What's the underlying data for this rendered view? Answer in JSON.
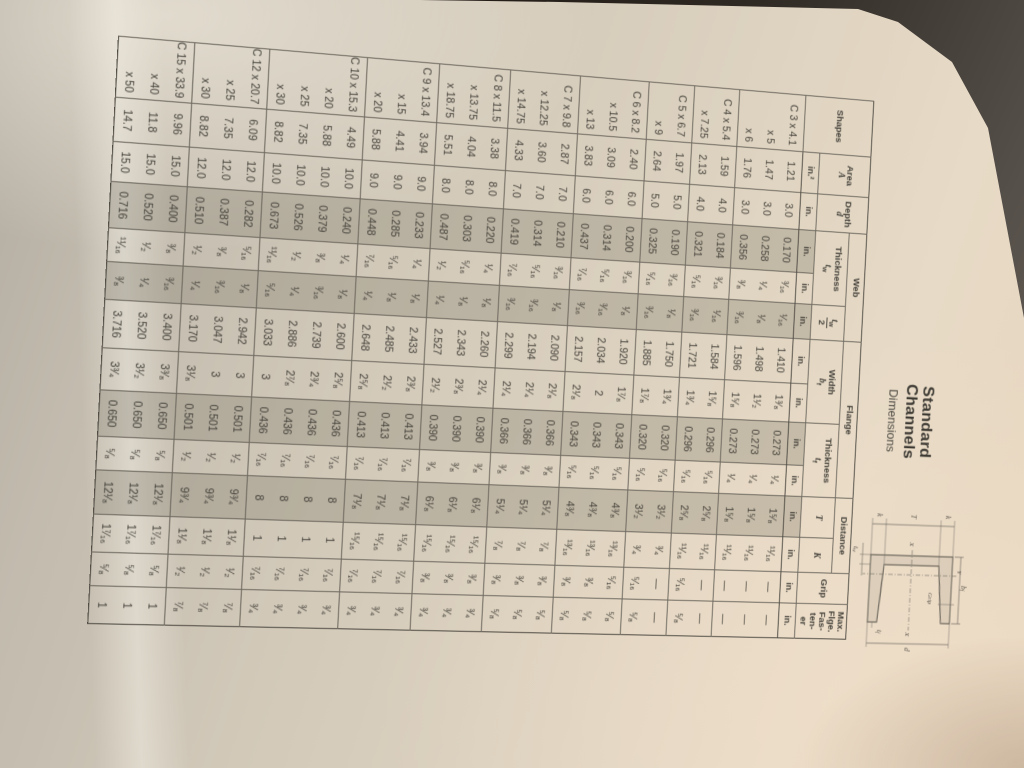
{
  "photo": {
    "background_dark": "#211a15",
    "background_wedge": "#6b645b",
    "paper_light": "#e7dac6",
    "paper_shadow": "#b2aba0",
    "table_line": "#6e695f",
    "band_shade": "#b4aea2",
    "ink": "#44413a"
  },
  "title": {
    "line1": "Standard",
    "line2": "Channels",
    "line3": "Dimensions"
  },
  "diagram": {
    "k_top": "k",
    "t_mid": "T",
    "k_bottom": "k",
    "depth": "d",
    "axis_x_left": "X",
    "axis_x_right": "X",
    "axis_y": "Y",
    "grip": "Grip",
    "width_sym": "b",
    "width_sub": "f",
    "web_sym": "t",
    "web_sub": "w",
    "flange_sym": "t",
    "flange_sub": "f"
  },
  "table": {
    "headers": {
      "shapes": "Shapes",
      "area": "Area",
      "area_sym": "A",
      "depth": "Depth",
      "depth_sym": "d",
      "web": "Web",
      "thickness": "Thickness",
      "t_sym": "t",
      "w_sub": "w",
      "den2": "2",
      "flange": "Flange",
      "width": "Width",
      "b_sym": "b",
      "f_sub": "f",
      "distance": "Distance",
      "T": "T",
      "K": "K",
      "grip": "Grip",
      "max_lines": [
        "Max.",
        "Flge.",
        "Fas-",
        "ten-",
        "er"
      ]
    },
    "units": [
      "in.²",
      "in.",
      "in.",
      "in.",
      "in.",
      "in.",
      "in.",
      "in.",
      "in.",
      "in.",
      "in.",
      "in.",
      "in."
    ],
    "columns": [
      "Shapes",
      "Area A",
      "Depth d",
      "Web Thickness tw (dec)",
      "Web Thickness tw (frac)",
      "tw/2",
      "Flange Width bf (dec)",
      "Flange Width bf (frac)",
      "Flange Thickness tf (dec)",
      "Flange Thickness tf (frac)",
      "Distance T",
      "Distance K",
      "Grip",
      "Max. Flge. Fastener"
    ],
    "groups": [
      {
        "rows": [
          [
            "C 3 x 4.1",
            "1.21",
            "3.0",
            "0.170",
            "³⁄₁₆",
            "¹⁄₁₆",
            "1.410",
            "1³⁄₈",
            "0.273",
            "¹⁄₄",
            "1⁵⁄₈",
            "¹¹⁄₁₆",
            "—",
            "—"
          ],
          [
            "x 5",
            "1.47",
            "3.0",
            "0.258",
            "¹⁄₄",
            "¹⁄₈",
            "1.498",
            "1¹⁄₂",
            "0.273",
            "¹⁄₄",
            "1⁵⁄₈",
            "¹¹⁄₁₆",
            "—",
            "—"
          ],
          [
            "x 6",
            "1.76",
            "3.0",
            "0.356",
            "³⁄₈",
            "³⁄₁₆",
            "1.596",
            "1⁵⁄₈",
            "0.273",
            "¹⁄₄",
            "1⁵⁄₈",
            "¹¹⁄₁₆",
            "—",
            "—"
          ]
        ]
      },
      {
        "rows": [
          [
            "C 4 x 5.4",
            "1.59",
            "4.0",
            "0.184",
            "³⁄₁₆",
            "¹⁄₁₆",
            "1.584",
            "1⁵⁄₈",
            "0.296",
            "⁵⁄₁₆",
            "2⁵⁄₈",
            "¹¹⁄₁₆",
            "—",
            "—"
          ],
          [
            "x 7.25",
            "2.13",
            "4.0",
            "0.321",
            "⁵⁄₁₆",
            "³⁄₁₆",
            "1.721",
            "1³⁄₄",
            "0.296",
            "⁵⁄₁₆",
            "2⁵⁄₈",
            "¹¹⁄₁₆",
            "⁵⁄₁₆",
            "⁵⁄₈"
          ]
        ]
      },
      {
        "rows": [
          [
            "C 5 x 6.7",
            "1.97",
            "5.0",
            "0.190",
            "³⁄₁₆",
            "¹⁄₈",
            "1.750",
            "1³⁄₄",
            "0.320",
            "⁵⁄₁₆",
            "3¹⁄₂",
            "³⁄₄",
            "—",
            "—"
          ],
          [
            "x 9",
            "2.64",
            "5.0",
            "0.325",
            "⁵⁄₁₆",
            "³⁄₁₆",
            "1.885",
            "1⁷⁄₈",
            "0.320",
            "⁵⁄₁₆",
            "3¹⁄₂",
            "³⁄₄",
            "⁵⁄₁₆",
            "⁵⁄₈"
          ]
        ]
      },
      {
        "rows": [
          [
            "C 6 x 8.2",
            "2.40",
            "6.0",
            "0.200",
            "³⁄₁₆",
            "¹⁄₈",
            "1.920",
            "1⁷⁄₈",
            "0.343",
            "⁵⁄₁₆",
            "4³⁄₈",
            "¹³⁄₁₆",
            "⁵⁄₁₆",
            "⁵⁄₈"
          ],
          [
            "x 10.5",
            "3.09",
            "6.0",
            "0.314",
            "⁵⁄₁₆",
            "³⁄₁₆",
            "2.034",
            "2",
            "0.343",
            "⁵⁄₁₆",
            "4³⁄₈",
            "¹³⁄₁₆",
            "³⁄₈",
            "⁵⁄₈"
          ],
          [
            "x 13",
            "3.83",
            "6.0",
            "0.437",
            "⁷⁄₁₆",
            "³⁄₁₆",
            "2.157",
            "2¹⁄₈",
            "0.343",
            "⁵⁄₁₆",
            "4³⁄₈",
            "¹³⁄₁₆",
            "³⁄₈",
            "⁵⁄₈"
          ]
        ]
      },
      {
        "rows": [
          [
            "C 7 x 9.8",
            "2.87",
            "7.0",
            "0.210",
            "³⁄₁₆",
            "¹⁄₈",
            "2.090",
            "2¹⁄₈",
            "0.366",
            "³⁄₈",
            "5¹⁄₄",
            "⁷⁄₈",
            "³⁄₈",
            "⁵⁄₈"
          ],
          [
            "x 12.25",
            "3.60",
            "7.0",
            "0.314",
            "⁵⁄₁₆",
            "³⁄₁₆",
            "2.194",
            "2¹⁄₄",
            "0.366",
            "³⁄₈",
            "5¹⁄₄",
            "⁷⁄₈",
            "³⁄₈",
            "⁵⁄₈"
          ],
          [
            "x 14.75",
            "4.33",
            "7.0",
            "0.419",
            "⁷⁄₁₆",
            "³⁄₁₆",
            "2.299",
            "2¹⁄₄",
            "0.366",
            "³⁄₈",
            "5¹⁄₄",
            "⁷⁄₈",
            "³⁄₈",
            "⁵⁄₈"
          ]
        ]
      },
      {
        "rows": [
          [
            "C 8 x 11.5",
            "3.38",
            "8.0",
            "0.220",
            "¹⁄₄",
            "¹⁄₈",
            "2.260",
            "2¹⁄₄",
            "0.390",
            "³⁄₈",
            "6¹⁄₈",
            "¹⁵⁄₁₆",
            "³⁄₈",
            "³⁄₄"
          ],
          [
            "x 13.75",
            "4.04",
            "8.0",
            "0.303",
            "⁵⁄₁₆",
            "¹⁄₈",
            "2.343",
            "2³⁄₈",
            "0.390",
            "³⁄₈",
            "6¹⁄₈",
            "¹⁵⁄₁₆",
            "³⁄₈",
            "³⁄₄"
          ],
          [
            "x 18.75",
            "5.51",
            "8.0",
            "0.487",
            "¹⁄₂",
            "¹⁄₄",
            "2.527",
            "2¹⁄₂",
            "0.390",
            "³⁄₈",
            "6¹⁄₈",
            "¹⁵⁄₁₆",
            "³⁄₈",
            "³⁄₄"
          ]
        ]
      },
      {
        "rows": [
          [
            "C 9 x 13.4",
            "3.94",
            "9.0",
            "0.233",
            "¹⁄₄",
            "¹⁄₈",
            "2.433",
            "2³⁄₈",
            "0.413",
            "⁷⁄₁₆",
            "7¹⁄₈",
            "¹⁵⁄₁₆",
            "⁷⁄₁₆",
            "³⁄₄"
          ],
          [
            "x 15",
            "4.41",
            "9.0",
            "0.285",
            "⁵⁄₁₆",
            "¹⁄₈",
            "2.485",
            "2¹⁄₂",
            "0.413",
            "⁷⁄₁₆",
            "7¹⁄₈",
            "¹⁵⁄₁₆",
            "⁷⁄₁₆",
            "³⁄₄"
          ],
          [
            "x 20",
            "5.88",
            "9.0",
            "0.448",
            "⁷⁄₁₆",
            "¹⁄₄",
            "2.648",
            "2⁵⁄₈",
            "0.413",
            "⁷⁄₁₆",
            "7¹⁄₈",
            "¹⁵⁄₁₆",
            "⁷⁄₁₆",
            "³⁄₄"
          ]
        ]
      },
      {
        "rows": [
          [
            "C 10 x 15.3",
            "4.49",
            "10.0",
            "0.240",
            "¹⁄₄",
            "¹⁄₈",
            "2.600",
            "2⁵⁄₈",
            "0.436",
            "⁷⁄₁₆",
            "8",
            "1",
            "⁷⁄₁₆",
            "³⁄₄"
          ],
          [
            "x 20",
            "5.88",
            "10.0",
            "0.379",
            "³⁄₈",
            "³⁄₁₆",
            "2.739",
            "2³⁄₄",
            "0.436",
            "⁷⁄₁₆",
            "8",
            "1",
            "⁷⁄₁₆",
            "³⁄₄"
          ],
          [
            "x 25",
            "7.35",
            "10.0",
            "0.526",
            "¹⁄₂",
            "¹⁄₄",
            "2.886",
            "2⁷⁄₈",
            "0.436",
            "⁷⁄₁₆",
            "8",
            "1",
            "⁷⁄₁₆",
            "³⁄₄"
          ],
          [
            "x 30",
            "8.82",
            "10.0",
            "0.673",
            "¹¹⁄₁₆",
            "⁵⁄₁₆",
            "3.033",
            "3",
            "0.436",
            "⁷⁄₁₆",
            "8",
            "1",
            "⁷⁄₁₆",
            "³⁄₄"
          ]
        ]
      },
      {
        "rows": [
          [
            "C 12 x 20.7",
            "6.09",
            "12.0",
            "0.282",
            "⁵⁄₁₆",
            "¹⁄₈",
            "2.942",
            "3",
            "0.501",
            "¹⁄₂",
            "9³⁄₄",
            "1¹⁄₈",
            "¹⁄₂",
            "⁷⁄₈"
          ],
          [
            "x 25",
            "7.35",
            "12.0",
            "0.387",
            "³⁄₈",
            "³⁄₁₆",
            "3.047",
            "3",
            "0.501",
            "¹⁄₂",
            "9³⁄₄",
            "1¹⁄₈",
            "¹⁄₂",
            "⁷⁄₈"
          ],
          [
            "x 30",
            "8.82",
            "12.0",
            "0.510",
            "¹⁄₂",
            "¹⁄₄",
            "3.170",
            "3¹⁄₈",
            "0.501",
            "¹⁄₂",
            "9³⁄₄",
            "1¹⁄₈",
            "¹⁄₂",
            "⁷⁄₈"
          ]
        ]
      },
      {
        "rows": [
          [
            "C 15 x 33.9",
            "9.96",
            "15.0",
            "0.400",
            "³⁄₈",
            "³⁄₁₆",
            "3.400",
            "3³⁄₈",
            "0.650",
            "⁵⁄₈",
            "12¹⁄₈",
            "1⁷⁄₁₆",
            "⁵⁄₈",
            "1"
          ],
          [
            "x 40",
            "11.8",
            "15.0",
            "0.520",
            "¹⁄₂",
            "¹⁄₄",
            "3.520",
            "3¹⁄₂",
            "0.650",
            "⁵⁄₈",
            "12¹⁄₈",
            "1⁷⁄₁₆",
            "⁵⁄₈",
            "1"
          ],
          [
            "x 50",
            "14.7",
            "15.0",
            "0.716",
            "¹¹⁄₁₆",
            "³⁄₈",
            "3.716",
            "3³⁄₄",
            "0.650",
            "⁵⁄₈",
            "12¹⁄₈",
            "1⁷⁄₁₆",
            "⁵⁄₈",
            "1"
          ]
        ]
      }
    ]
  }
}
